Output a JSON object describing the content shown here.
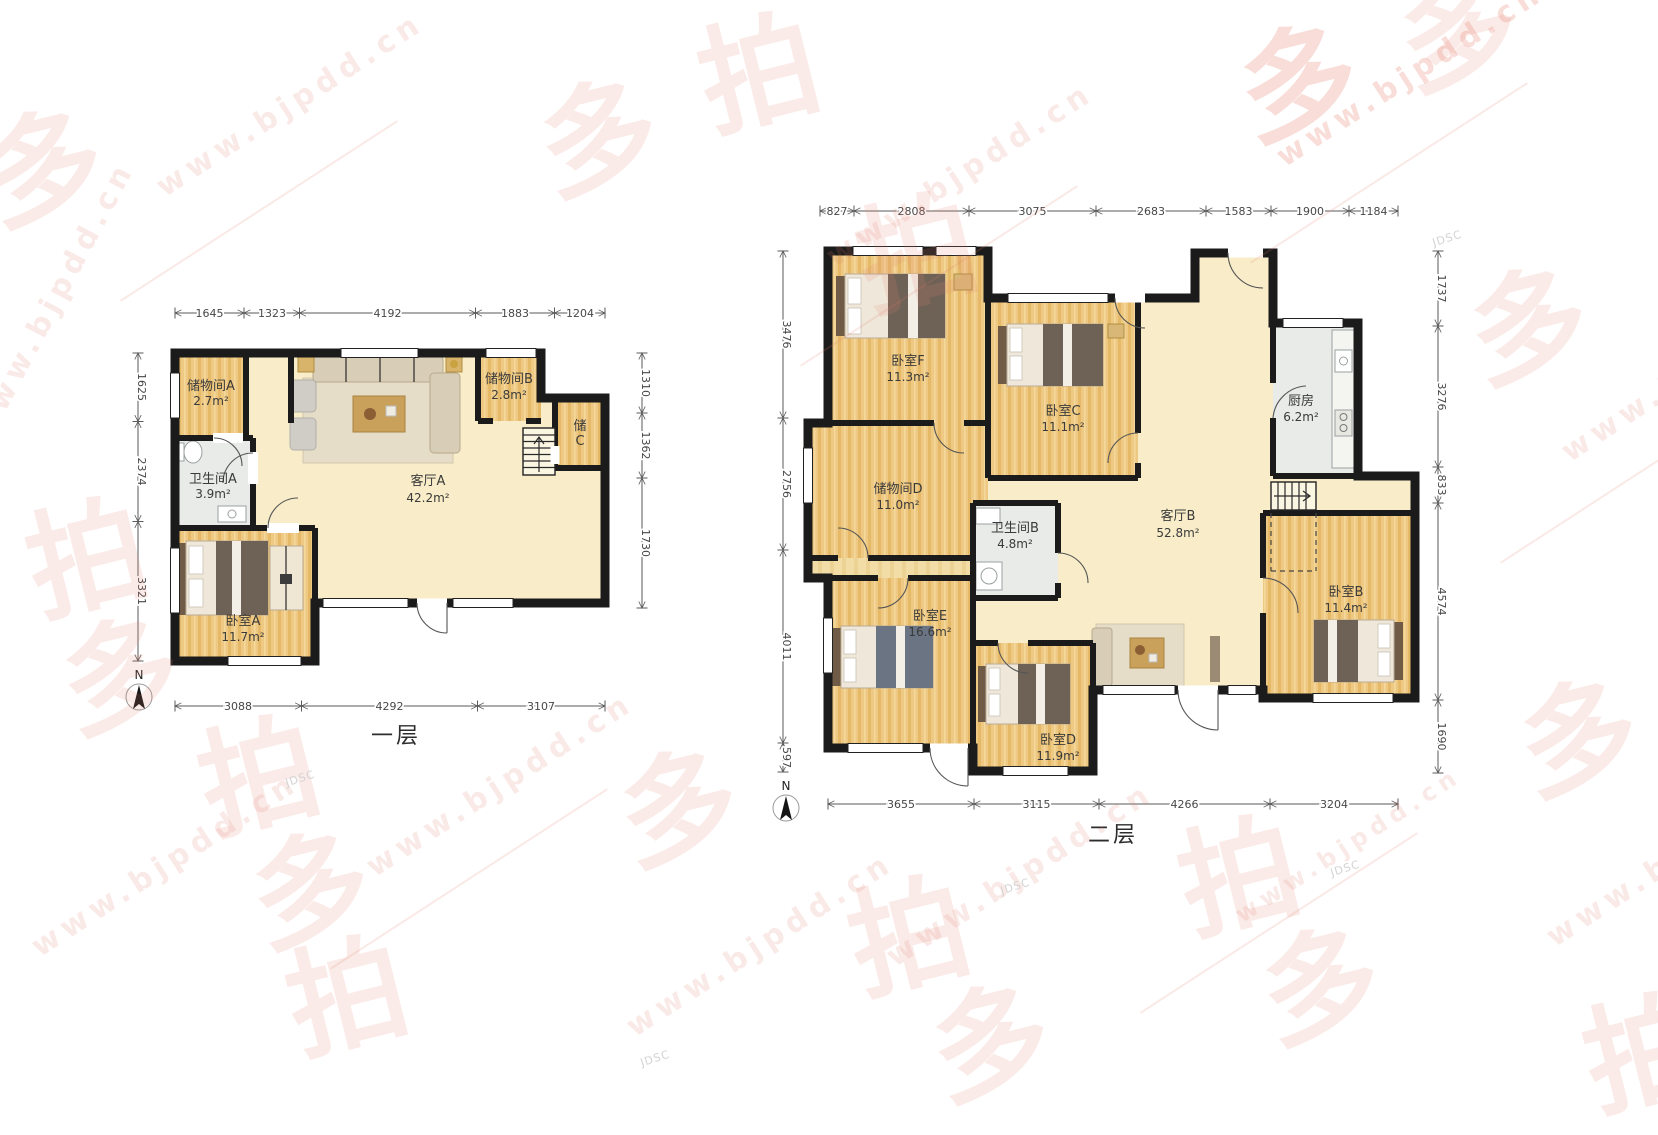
{
  "watermark": {
    "site": "www.bjpdd.cn",
    "char_pai": "拍",
    "char_duo": "多",
    "small_text": "JDSC"
  },
  "floor1": {
    "name": "一层",
    "compass_label": "N",
    "rooms": {
      "storage_a": {
        "name": "储物间A",
        "area": "2.7m²"
      },
      "bath_a": {
        "name": "卫生间A",
        "area": "3.9m²"
      },
      "bedroom_a": {
        "name": "卧室A",
        "area": "11.7m²"
      },
      "living_a": {
        "name": "客厅A",
        "area": "42.2m²"
      },
      "storage_b": {
        "name": "储物间B",
        "area": "2.8m²"
      },
      "storage_c": {
        "line1": "储",
        "line2": "C"
      }
    },
    "dims": {
      "top": [
        "1645",
        "1323",
        "4192",
        "1883",
        "1204"
      ],
      "bottom": [
        "3088",
        "4292",
        "3107"
      ],
      "left": [
        "1625",
        "2374",
        "3321"
      ],
      "right": [
        "1310",
        "1362",
        "1730"
      ]
    }
  },
  "floor2": {
    "name": "二层",
    "compass_label": "N",
    "rooms": {
      "bedroom_f": {
        "name": "卧室F",
        "area": "11.3m²"
      },
      "bedroom_c": {
        "name": "卧室C",
        "area": "11.1m²"
      },
      "storage_d": {
        "name": "储物间D",
        "area": "11.0m²"
      },
      "bath_b": {
        "name": "卫生间B",
        "area": "4.8m²"
      },
      "bedroom_e": {
        "name": "卧室E",
        "area": "16.6m²"
      },
      "bedroom_d": {
        "name": "卧室D",
        "area": "11.9m²"
      },
      "living_b": {
        "name": "客厅B",
        "area": "52.8m²"
      },
      "kitchen": {
        "name": "厨房",
        "area": "6.2m²"
      },
      "bedroom_b": {
        "name": "卧室B",
        "area": "11.4m²"
      }
    },
    "dims": {
      "top": [
        "827",
        "2808",
        "3075",
        "2683",
        "1583",
        "1900",
        "1184"
      ],
      "bottom": [
        "3655",
        "3115",
        "4266",
        "3204"
      ],
      "left": [
        "3476",
        "2756",
        "4011",
        "597"
      ],
      "right": [
        "1737",
        "3276",
        "833",
        "4574",
        "1690"
      ]
    }
  }
}
